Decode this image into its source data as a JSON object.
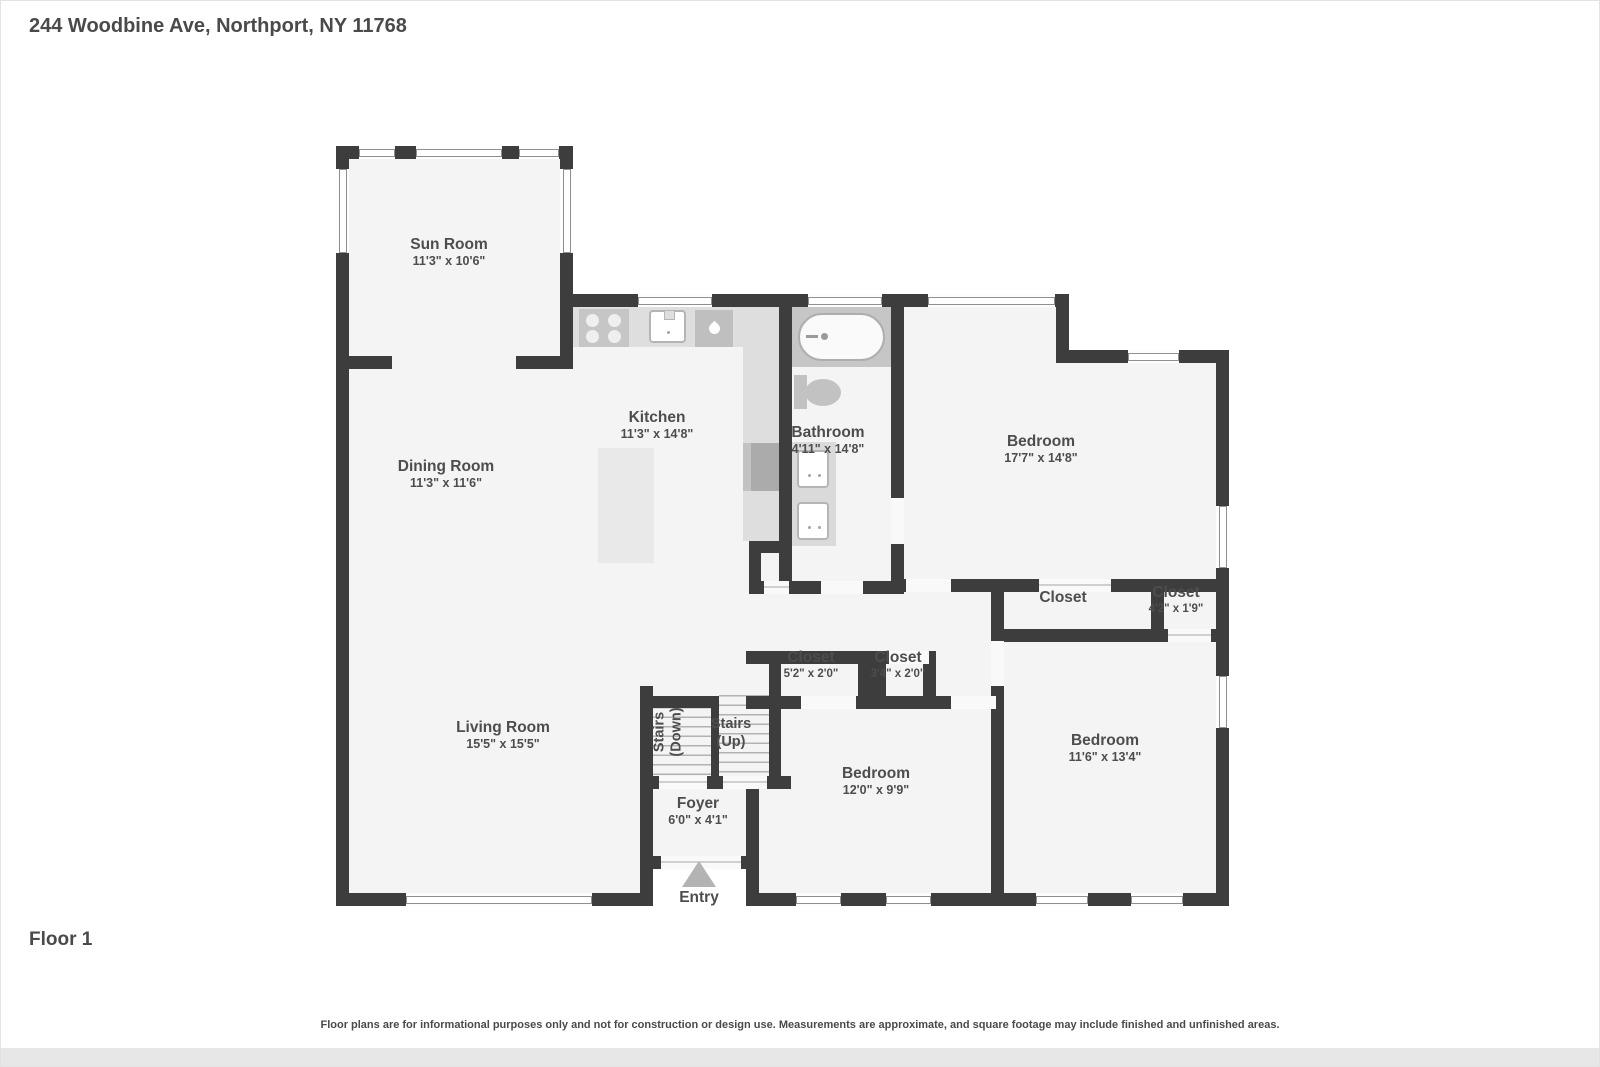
{
  "header": {
    "address": "244 Woodbine Ave, Northport, NY 11768"
  },
  "floor": {
    "label": "Floor 1"
  },
  "footer": {
    "disclaimer": "Floor plans are for informational purposes only and not for construction or design use. Measurements are approximate, and square footage may include finished and unfinished areas."
  },
  "rooms": {
    "sun_room": {
      "name": "Sun Room",
      "dims": "11'3\" x 10'6\""
    },
    "kitchen": {
      "name": "Kitchen",
      "dims": "11'3\" x 14'8\""
    },
    "dining_room": {
      "name": "Dining Room",
      "dims": "11'3\" x 11'6\""
    },
    "bathroom": {
      "name": "Bathroom",
      "dims": "4'11\" x 14'8\""
    },
    "bedroom_1": {
      "name": "Bedroom",
      "dims": "17'7\" x 14'8\""
    },
    "closet_hall": {
      "name": "Closet",
      "dims": ""
    },
    "closet_right": {
      "name": "Closet",
      "dims": "4'2\" x 1'9\""
    },
    "closet_mid_left": {
      "name": "Closet",
      "dims": "5'2\" x 2'0\""
    },
    "closet_mid_right": {
      "name": "Closet",
      "dims": "3'4\" x 2'0\""
    },
    "stairs_down": {
      "line1": "Stairs",
      "line2": "(Down)"
    },
    "stairs_up": {
      "line1": "Stairs",
      "line2": "(Up)"
    },
    "living_room": {
      "name": "Living Room",
      "dims": "15'5\" x 15'5\""
    },
    "bedroom_2": {
      "name": "Bedroom",
      "dims": "12'0\" x 9'9\""
    },
    "bedroom_3": {
      "name": "Bedroom",
      "dims": "11'6\" x 13'4\""
    },
    "foyer": {
      "name": "Foyer",
      "dims": "6'0\" x 4'1\""
    },
    "entry": {
      "name": "Entry"
    }
  },
  "colors": {
    "wall": "#3d3d3d",
    "room_fill": "#f4f4f4",
    "fixture": "#c6c6c6",
    "text": "#4d4d4d"
  }
}
